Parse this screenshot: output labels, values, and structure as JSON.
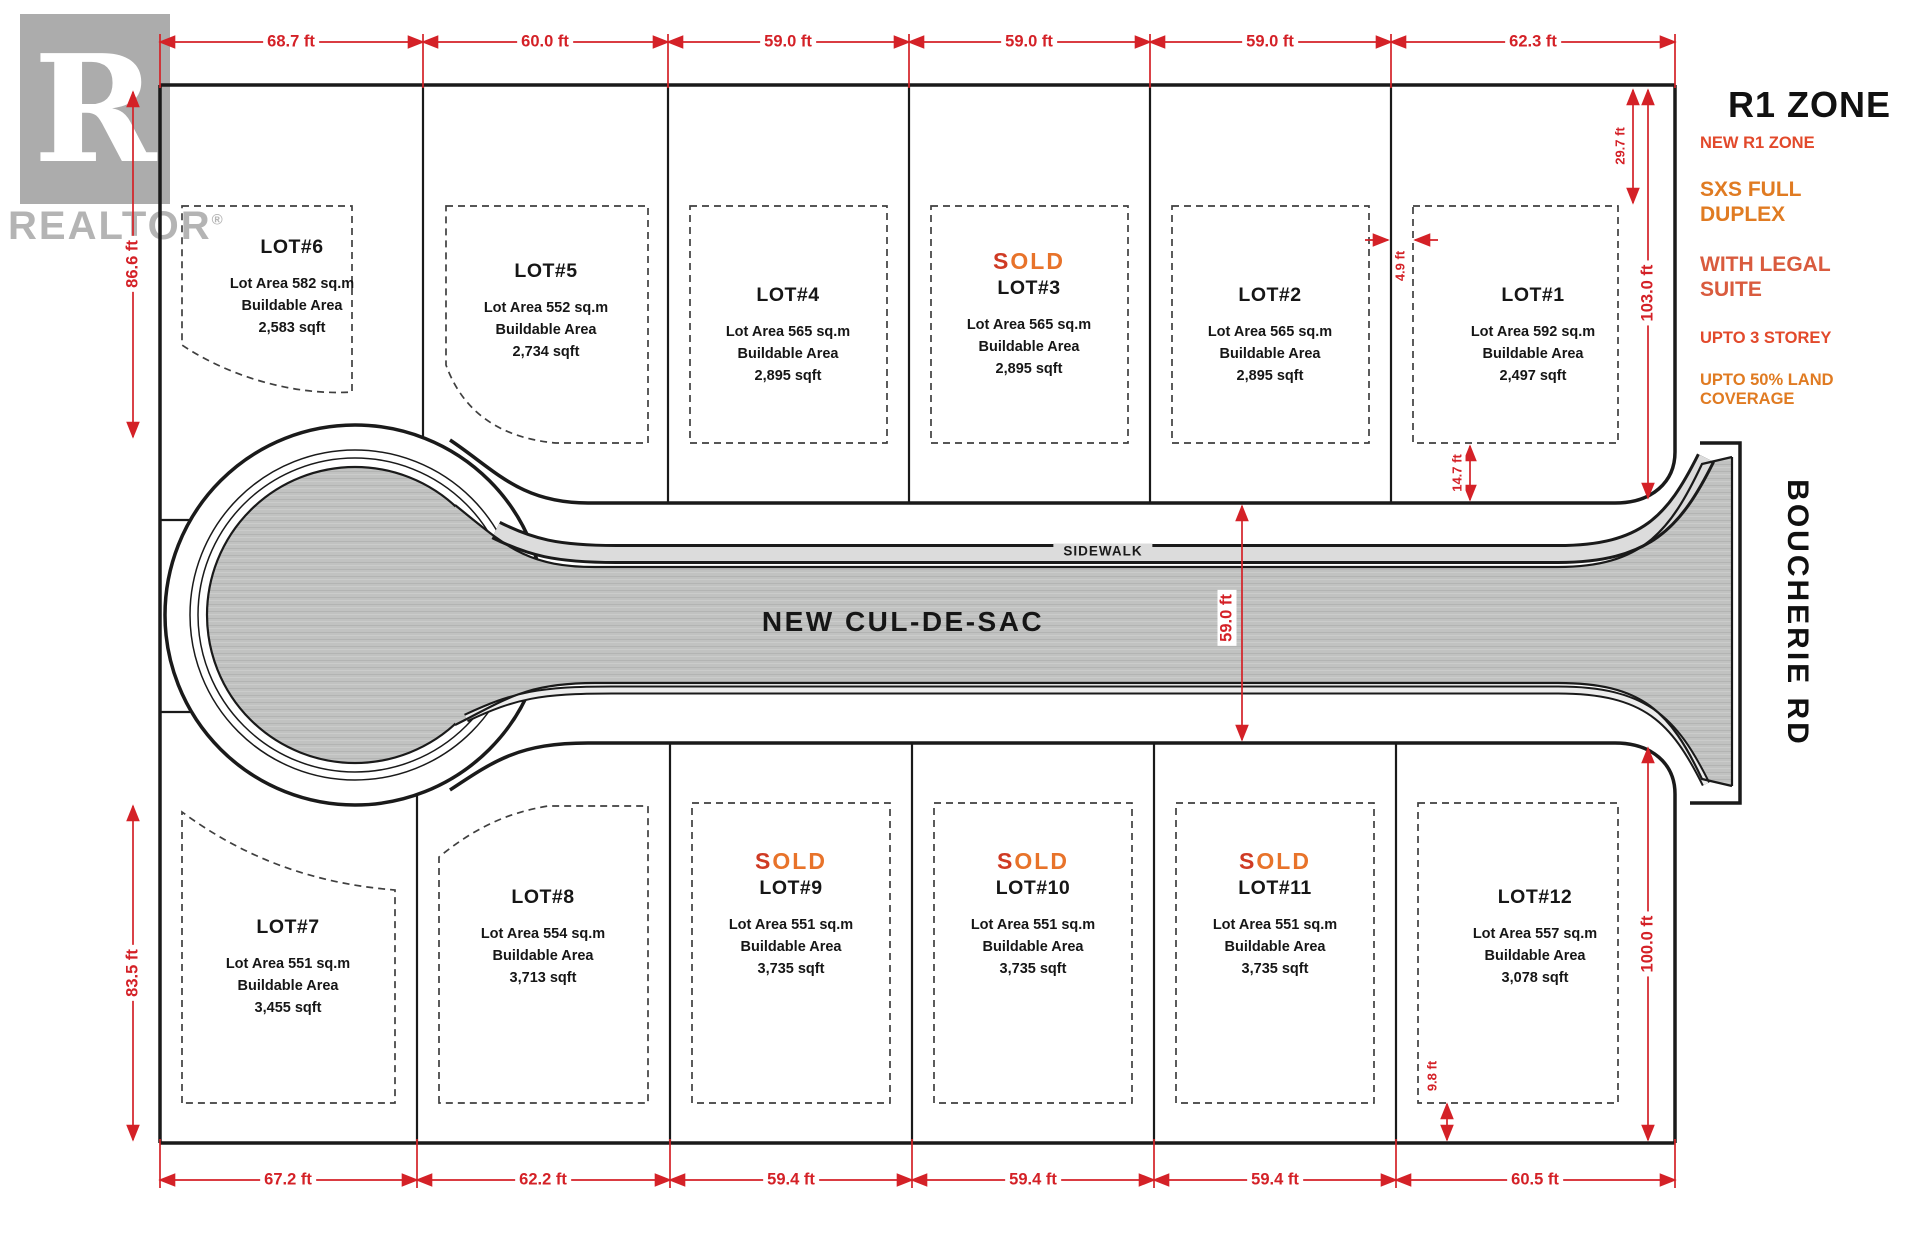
{
  "colors": {
    "dimension_red": "#d42127",
    "line_black": "#1a1a1a",
    "dashed_gray": "#3f3f3f",
    "road_fill": "#c1c2c1",
    "road_streak_dark": "#b3b4b3",
    "road_streak_light": "#cbccCB",
    "sidewalk_fill": "#dcdcdc",
    "sold_main": "#e8732a",
    "sold_accent": "#cf3a24",
    "zone_title": "#111111",
    "zone_red": "#e2492b",
    "zone_orange": "#e07b22",
    "zone_rust": "#d95b3e",
    "lot_text": "#161616",
    "logo_gray": "#acacac",
    "logo_text": "#b4b4b4"
  },
  "branding": {
    "logo_letter": "R",
    "logo_wordmark": "REALTOR",
    "logo_registered": "®"
  },
  "zone_panel": {
    "title": "R1 ZONE",
    "items": [
      {
        "label": "NEW R1 ZONE"
      },
      {
        "label": "SXS FULL DUPLEX"
      },
      {
        "label": "WITH LEGAL SUITE"
      },
      {
        "label": "UPTO 3 STOREY"
      },
      {
        "label": "UPTO 50% LAND COVERAGE"
      }
    ]
  },
  "road": {
    "label": "NEW CUL-DE-SAC",
    "sidewalk_label": "SIDEWALK",
    "cross_street_label": "BOUCHERIE RD"
  },
  "lots": [
    {
      "name": "LOT#1",
      "area": "Lot Area 592 sq.m",
      "buildable_label": "Buildable Area",
      "buildable_sqft": "2,497 sqft"
    },
    {
      "name": "LOT#2",
      "area": "Lot Area 565 sq.m",
      "buildable_label": "Buildable Area",
      "buildable_sqft": "2,895 sqft"
    },
    {
      "name": "LOT#3",
      "status": "SOLD",
      "area": "Lot Area 565 sq.m",
      "buildable_label": "Buildable Area",
      "buildable_sqft": "2,895 sqft"
    },
    {
      "name": "LOT#4",
      "area": "Lot Area 565 sq.m",
      "buildable_label": "Buildable Area",
      "buildable_sqft": "2,895 sqft"
    },
    {
      "name": "LOT#5",
      "area": "Lot Area 552 sq.m",
      "buildable_label": "Buildable Area",
      "buildable_sqft": "2,734 sqft"
    },
    {
      "name": "LOT#6",
      "area": "Lot Area 582 sq.m",
      "buildable_label": "Buildable Area",
      "buildable_sqft": "2,583 sqft"
    },
    {
      "name": "LOT#7",
      "area": "Lot Area 551 sq.m",
      "buildable_label": "Buildable Area",
      "buildable_sqft": "3,455 sqft"
    },
    {
      "name": "LOT#8",
      "area": "Lot Area 554 sq.m",
      "buildable_label": "Buildable Area",
      "buildable_sqft": "3,713 sqft"
    },
    {
      "name": "LOT#9",
      "status": "SOLD",
      "area": "Lot Area 551 sq.m",
      "buildable_label": "Buildable Area",
      "buildable_sqft": "3,735 sqft"
    },
    {
      "name": "LOT#10",
      "status": "SOLD",
      "area": "Lot Area 551 sq.m",
      "buildable_label": "Buildable Area",
      "buildable_sqft": "3,735 sqft"
    },
    {
      "name": "LOT#11",
      "status": "SOLD",
      "area": "Lot Area 551 sq.m",
      "buildable_label": "Buildable Area",
      "buildable_sqft": "3,735 sqft"
    },
    {
      "name": "LOT#12",
      "area": "Lot Area 557 sq.m",
      "buildable_label": "Buildable Area",
      "buildable_sqft": "3,078 sqft"
    }
  ],
  "dimensions": {
    "top": [
      "68.7 ft",
      "60.0 ft",
      "59.0 ft",
      "59.0 ft",
      "59.0 ft",
      "62.3 ft"
    ],
    "bottom": [
      "67.2 ft",
      "62.2 ft",
      "59.4 ft",
      "59.4 ft",
      "59.4 ft",
      "60.5 ft"
    ],
    "left_upper": "86.6 ft",
    "left_lower": "83.5 ft",
    "right_upper": "103.0 ft",
    "right_lower": "100.0 ft",
    "road_width": "59.0 ft",
    "lot1_front_setback": "29.7 ft",
    "lot1_rear_setback": "14.7 ft",
    "lot1_side_gap": "4.9 ft",
    "lot12_rear_setback": "9.8 ft"
  }
}
